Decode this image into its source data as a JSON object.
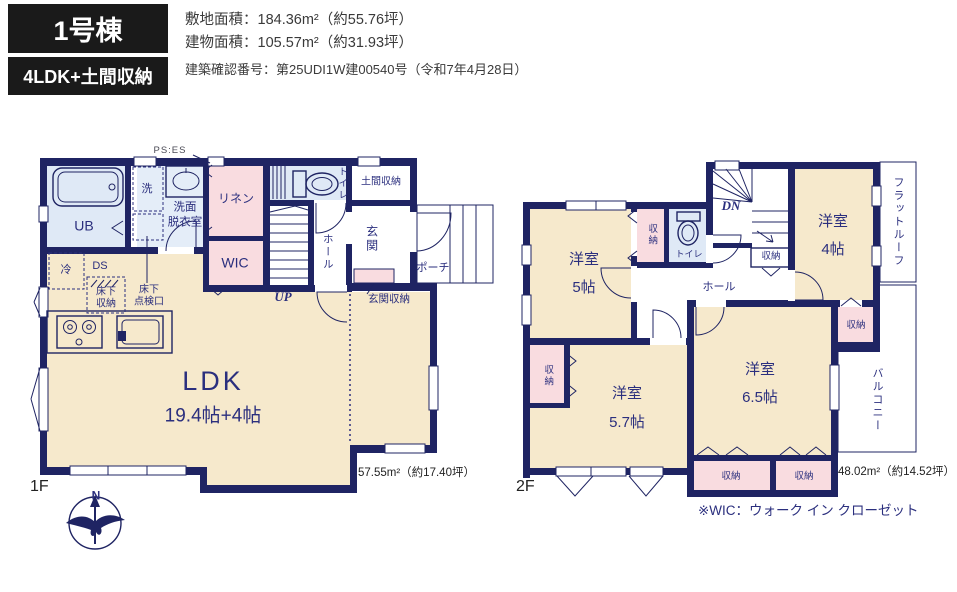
{
  "header": {
    "unit": "1号棟",
    "layout": "4LDK+土間収納",
    "site_area": "敷地面積：184.36m²（約55.76坪）",
    "building_area": "建物面積：105.57m²（約31.93坪）",
    "permit": "建築確認番号：第25UDI1W建00540号（令和7年4月28日）"
  },
  "floor1": {
    "name": "1F",
    "area": "57.55m²（約17.40坪）",
    "labels": {
      "ub": "UB",
      "laundry": "洗",
      "washroom1": "洗面",
      "washroom2": "脱衣室",
      "linen": "リネン",
      "wic": "WIC",
      "ps_es": "PS:ES",
      "toilet": "トイレ",
      "doma": "土間収納",
      "genkan": "玄関",
      "hall": "ホール",
      "porch": "ポーチ",
      "up": "UP",
      "genkan_storage": "玄関収納",
      "fridge": "冷",
      "ds": "DS",
      "underfloor1a": "床下",
      "underfloor1b": "収納",
      "underfloor2a": "床下",
      "underfloor2b": "点検口",
      "ldk": "LDK",
      "ldk_size": "19.4帖+4帖",
      "compass_n": "N"
    }
  },
  "floor2": {
    "name": "2F",
    "area": "48.02m²（約14.52坪）",
    "note": "※WIC：ウォーク イン クローゼット",
    "labels": {
      "room5_name": "洋室",
      "room5_size": "5帖",
      "room4_name": "洋室",
      "room4_size": "4帖",
      "room57_name": "洋室",
      "room57_size": "5.7帖",
      "room65_name": "洋室",
      "room65_size": "6.5帖",
      "toilet": "トイレ",
      "hall": "ホール",
      "dn": "DN",
      "closet_a": "収納",
      "closet_stairs": "収納",
      "closet_4": "収納",
      "closet_57": "収納",
      "closet_b1": "収納",
      "closet_b2": "収納",
      "flat_roof": "フラットルーフ",
      "balcony": "バルコニー"
    }
  },
  "colors": {
    "wall_navy": "#1f2463",
    "text_navy": "#2b2f7e",
    "room_beige": "#f6e9cc",
    "closet_pink": "#f9dce0",
    "wet_blue": "#dfe9f6",
    "header_bg": "#1a1a1a"
  }
}
